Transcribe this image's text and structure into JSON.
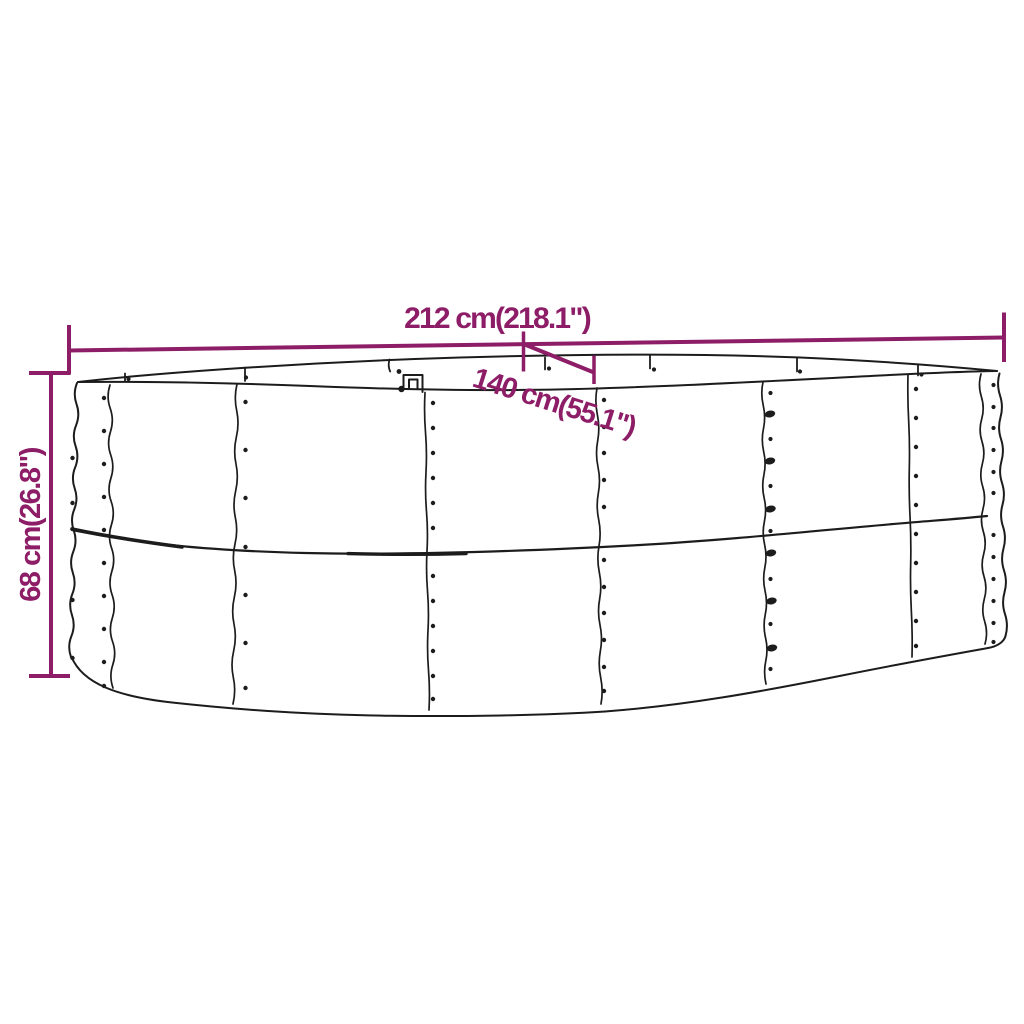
{
  "colors": {
    "dimension": "#8d1d67",
    "line_art": "#1c1c1c",
    "background": "#ffffff"
  },
  "dimensions": {
    "width": {
      "label": "212 cm(218.1\")"
    },
    "depth": {
      "label": "140 cm(55.1\")"
    },
    "height": {
      "label": "68 cm(26.8\")"
    }
  }
}
